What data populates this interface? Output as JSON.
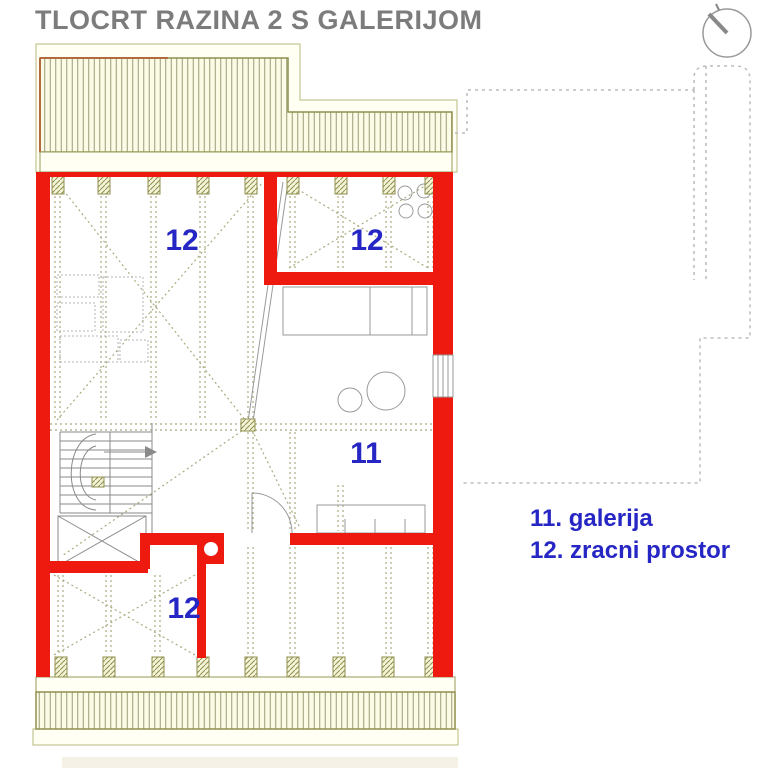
{
  "title": "TLOCRT RAZINA 2 S GALERIJOM",
  "plan": {
    "room_labels": [
      {
        "id": "room-12-top-left",
        "text": "12"
      },
      {
        "id": "room-12-top-right",
        "text": "12"
      },
      {
        "id": "room-11-gallery",
        "text": "11"
      },
      {
        "id": "room-12-bottom",
        "text": "12"
      }
    ]
  },
  "legend": {
    "items": [
      "11. galerija",
      "12. zracni prostor"
    ]
  },
  "compass": {
    "icon": "north-indicator"
  },
  "colors": {
    "wall_red": "#ee1a10",
    "label_blue": "#2626c4",
    "title_gray": "#7c7c7c",
    "roof_fill": "#fcfce6",
    "roof_stroke": "#8f8f4f",
    "hatch_line": "#9a9a7a",
    "joist_dotted": "#aaaa80",
    "furniture_gray": "#9a9a9a",
    "lower_floor_dashed": "#bbbbbb"
  }
}
